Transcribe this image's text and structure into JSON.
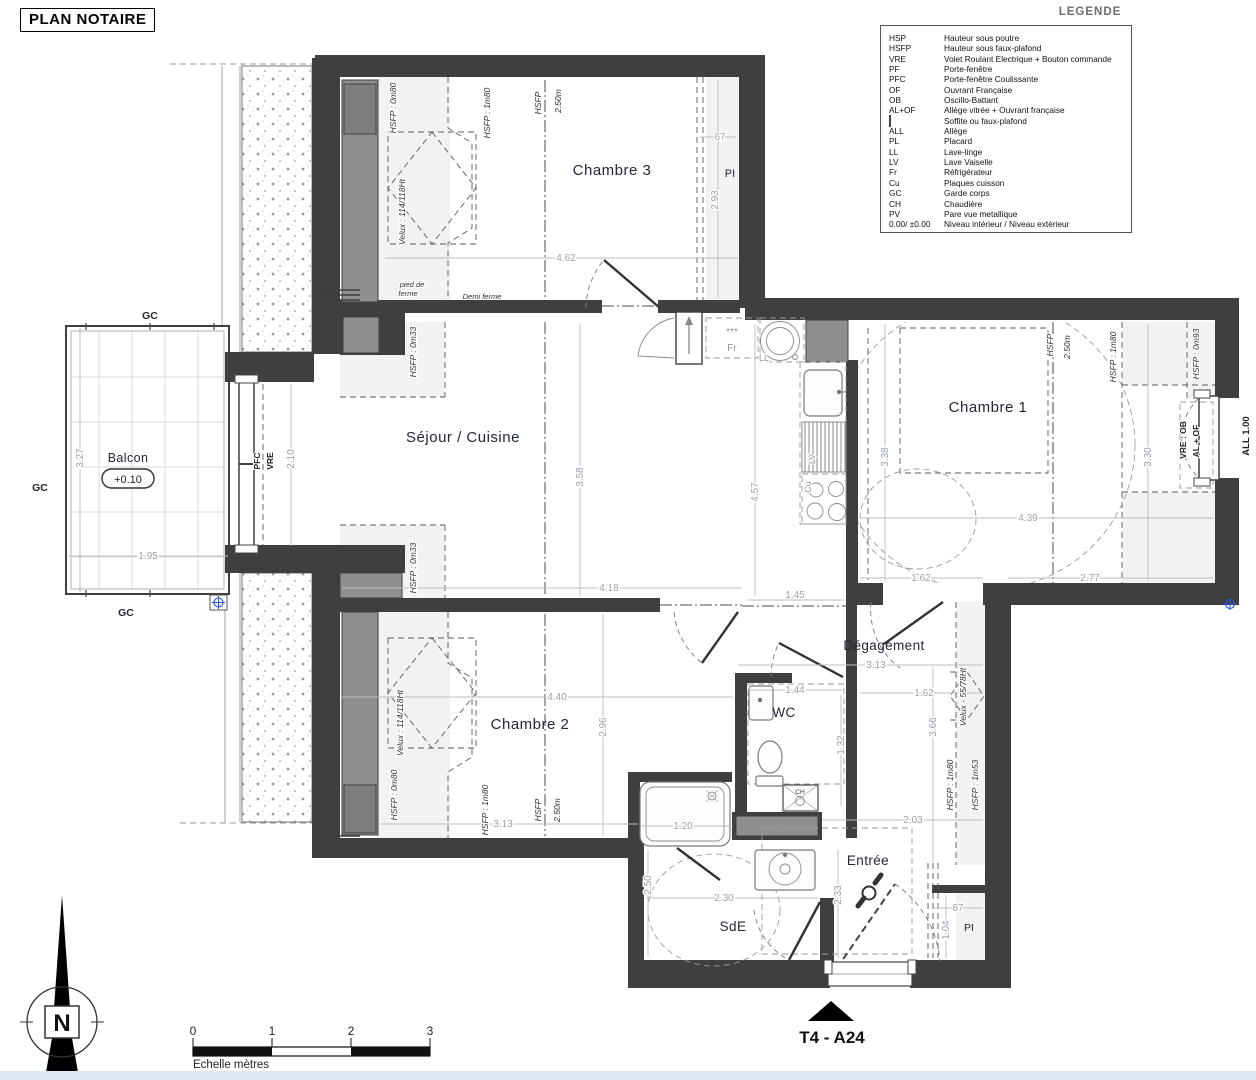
{
  "title": "PLAN NOTAIRE",
  "unit_label": "T4 - A24",
  "legend": {
    "title": "LEGENDE",
    "entries": [
      {
        "abbr": "HSP",
        "desc": "Hauteur sous poutre"
      },
      {
        "abbr": "HSFP",
        "desc": "Hauteur sous faux-plafond"
      },
      {
        "abbr": "VRE",
        "desc": "Volet Roulant Electrique + Bouton commande"
      },
      {
        "abbr": "PF",
        "desc": "Porte-fenêtre"
      },
      {
        "abbr": "PFC",
        "desc": "Porte-fenêtre Coulissante"
      },
      {
        "abbr": "OF",
        "desc": "Ouvrant Française"
      },
      {
        "abbr": "OB",
        "desc": "Oscillo-Battant"
      },
      {
        "abbr": "AL+OF",
        "desc": "Allège vitrée + Ouvrant française"
      },
      {
        "abbr": "",
        "desc": "Soffite ou faux-plafond"
      },
      {
        "abbr": "ALL",
        "desc": "Allège"
      },
      {
        "abbr": "PL",
        "desc": "Placard"
      },
      {
        "abbr": "LL",
        "desc": "Lave-linge"
      },
      {
        "abbr": "LV",
        "desc": "Lave Vaiselle"
      },
      {
        "abbr": "Fr",
        "desc": "Réfrigérateur"
      },
      {
        "abbr": "Cu",
        "desc": "Plaques cuisson"
      },
      {
        "abbr": "GC",
        "desc": "Garde corps"
      },
      {
        "abbr": "CH",
        "desc": "Chaudière"
      },
      {
        "abbr": "PV",
        "desc": "Pare vue metallique"
      },
      {
        "abbr": "0.00/ ±0.00",
        "desc": "Niveau intérieur / Niveau extérieur"
      }
    ]
  },
  "rooms": {
    "chambre1": "Chambre 1",
    "chambre2": "Chambre 2",
    "chambre3": "Chambre 3",
    "sejour": "Séjour / Cuisine",
    "degagement": "Dégagement",
    "wc": "WC",
    "sde": "SdE",
    "entree": "Entrée",
    "balcon": "Balcon",
    "pi_top": "PI",
    "pi_bottom": "PI"
  },
  "balcony_level": "+0.10",
  "gc": {
    "top": "GC",
    "left": "GC",
    "bottom": "GC"
  },
  "appliances": {
    "fr": "Fr",
    "fr_stars": "***",
    "ll": "LL",
    "lv": "LV",
    "cu": "Cu",
    "ch": "CH"
  },
  "window_labels": {
    "pfc": "PFC",
    "vre": "VRE",
    "vre_ob": "VRE : OB",
    "al_of": "AL + OF",
    "all_100": "ALL 1.00"
  },
  "annotations": {
    "c3_hsfp_080": "HSFP : 0m80",
    "c3_hsfp_180": "HSFP : 1m80",
    "c3_hsfp": "HSFP",
    "c3_250": "2.50m",
    "c3_velux": "Velux : 114/118Ht",
    "pied_de": "pied de",
    "ferme": "ferme",
    "demi_ferme": "Demi ferme",
    "sej_hsfp_033_top": "HSFP : 0m33",
    "sej_hsfp_033_bot": "HSFP : 0m33",
    "c1_hsfp": "HSFP",
    "c1_250": "2.50m",
    "c1_hsfp_180": "HSFP : 1m80",
    "c1_hsfp_093": "HSFP : 0m93",
    "c2_velux": "Velux : 114/118Ht",
    "c2_hsfp_080": "HSFP : 0m80",
    "c2_hsfp_180": "HSFP : 1m80",
    "c2_hsfp": "HSFP",
    "c2_250": "2.50m",
    "deg_velux": "Velux - 55/78Ht",
    "deg_hsfp_180": "HSFP : 1m80",
    "deg_hsfp_153": "HSFP : 1m53"
  },
  "dims": {
    "c3_w": "4.62",
    "c3_h": "2.93",
    "c3_pl": "67",
    "balc_h": "3.27",
    "balc_w": "1.95",
    "pfc_h": "2.10",
    "sej_h": "3.58",
    "sej_w": "4.18",
    "sej_h2": "4.57",
    "sej_145": "1.45",
    "c1_h": "3.38",
    "c1_h2": "3.30",
    "c1_w": "4.39",
    "c1_162": "1.62",
    "c1_277": "2.77",
    "deg_313": "3.13",
    "deg_162": "1.62",
    "deg_366": "3.66",
    "deg_203": "2.03",
    "wc_w": "1.44",
    "wc_h": "1.32",
    "c2_w": "4.40",
    "c2_h": "2.96",
    "c2_313": "3.13",
    "c2_120": "1.20",
    "sde_h": "2.50",
    "sde_w": "2.30",
    "ent_h": "2.33",
    "pi_w": "67",
    "pi_h": "1.04"
  },
  "scale": {
    "t0": "0",
    "t1": "1",
    "t2": "2",
    "t3": "3",
    "caption": "Echelle mètres"
  },
  "compass": {
    "n": "N"
  }
}
